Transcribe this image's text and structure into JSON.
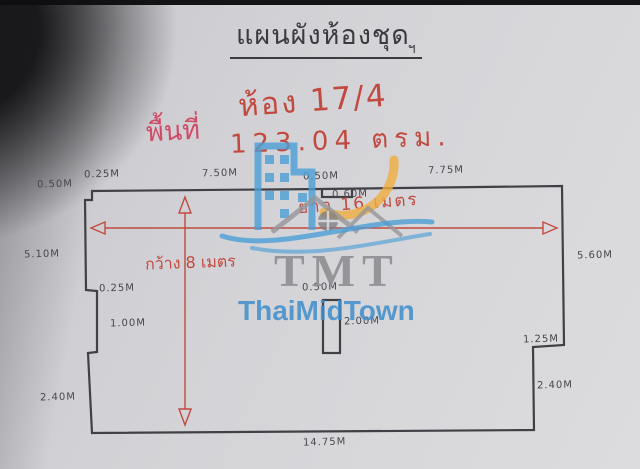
{
  "title": {
    "text": "แผนผังห้องชุด",
    "flourish": "ฯ"
  },
  "notes": {
    "room_number": "ห้อง 17/4",
    "area_label": "พื้นที่",
    "area_value": "123.04 ตรม.",
    "length_note": "ยาว 16 เมตร",
    "width_note": "กว้าง 8 เมตร"
  },
  "watermark": {
    "monogram": "TMT",
    "brand": "ThaiMidTown"
  },
  "dimensions": {
    "top_left_height": "0.50M",
    "top_left_step": "0.25M",
    "top_edge_left": "7.50M",
    "top_notch_width": "0.50M",
    "top_notch_depth": "0.60M",
    "top_edge_right": "7.75M",
    "left_upper": "5.10M",
    "left_step": "0.25M",
    "left_middle": "1.00M",
    "left_lower": "2.40M",
    "right_upper": "5.60M",
    "right_step": "1.25M",
    "right_lower": "2.40M",
    "bottom_edge": "14.75M",
    "pillar_width": "0.50M",
    "pillar_height": "2.00M"
  },
  "colors": {
    "red_ink": "#c2493f",
    "pink_ink": "#d04b66",
    "plan_ink": "#404046",
    "watermark_blue": "#4d9fd6",
    "watermark_orange": "#f1ae3f",
    "watermark_gray": "#96969b",
    "paper": "#d5d5d8"
  }
}
